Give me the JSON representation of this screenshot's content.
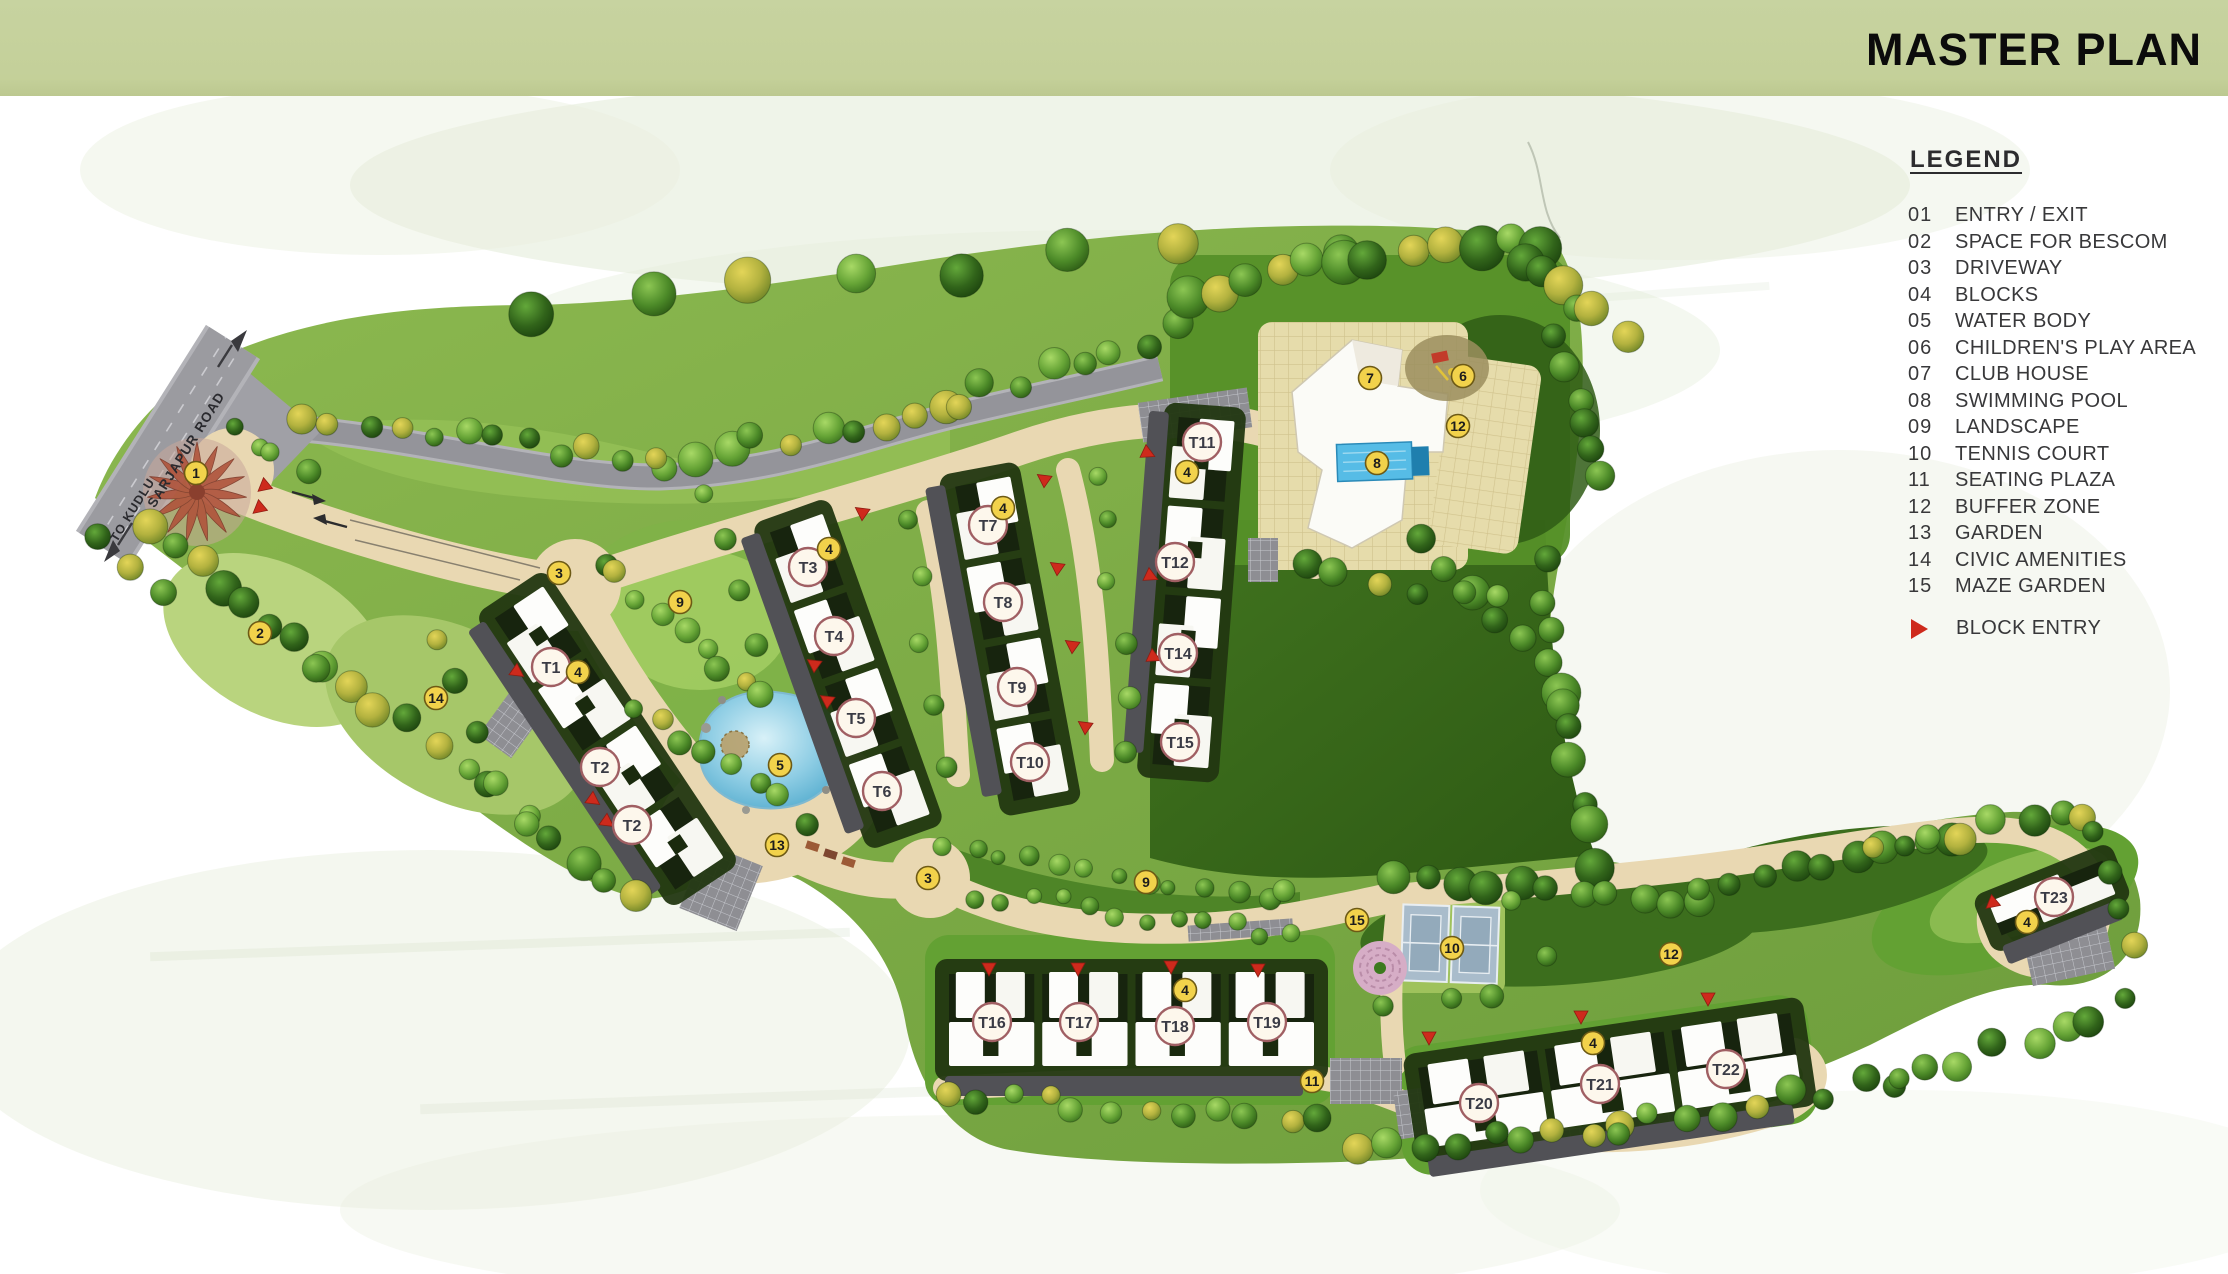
{
  "header": {
    "title": "MASTER PLAN"
  },
  "legend": {
    "title": "LEGEND",
    "items": [
      {
        "num": "01",
        "label": "ENTRY / EXIT"
      },
      {
        "num": "02",
        "label": "SPACE FOR BESCOM"
      },
      {
        "num": "03",
        "label": "DRIVEWAY"
      },
      {
        "num": "04",
        "label": "BLOCKS"
      },
      {
        "num": "05",
        "label": "WATER BODY"
      },
      {
        "num": "06",
        "label": "CHILDREN'S PLAY AREA"
      },
      {
        "num": "07",
        "label": "CLUB  HOUSE"
      },
      {
        "num": "08",
        "label": "SWIMMING POOL"
      },
      {
        "num": "09",
        "label": "LANDSCAPE"
      },
      {
        "num": "10",
        "label": "TENNIS COURT"
      },
      {
        "num": "11",
        "label": "SEATING PLAZA"
      },
      {
        "num": "12",
        "label": "BUFFER ZONE"
      },
      {
        "num": "13",
        "label": "GARDEN"
      },
      {
        "num": "14",
        "label": "CIVIC AMENITIES"
      },
      {
        "num": "15",
        "label": "MAZE GARDEN"
      }
    ],
    "block_entry_label": "BLOCK ENTRY"
  },
  "roads": {
    "sarjapur_label": "SARJAPUR ROAD",
    "kudlu_label": "TO KUDLU"
  },
  "map": {
    "numbered_markers": [
      {
        "n": "1",
        "x": 196,
        "y": 473
      },
      {
        "n": "2",
        "x": 260,
        "y": 633
      },
      {
        "n": "3",
        "x": 559,
        "y": 573
      },
      {
        "n": "3",
        "x": 928,
        "y": 878
      },
      {
        "n": "4",
        "x": 578,
        "y": 672
      },
      {
        "n": "4",
        "x": 829,
        "y": 549
      },
      {
        "n": "4",
        "x": 1003,
        "y": 508
      },
      {
        "n": "4",
        "x": 1187,
        "y": 472
      },
      {
        "n": "4",
        "x": 1185,
        "y": 990
      },
      {
        "n": "4",
        "x": 1593,
        "y": 1043
      },
      {
        "n": "4",
        "x": 2027,
        "y": 922
      },
      {
        "n": "5",
        "x": 780,
        "y": 765
      },
      {
        "n": "6",
        "x": 1463,
        "y": 376
      },
      {
        "n": "7",
        "x": 1370,
        "y": 378
      },
      {
        "n": "8",
        "x": 1377,
        "y": 463
      },
      {
        "n": "9",
        "x": 680,
        "y": 602
      },
      {
        "n": "9",
        "x": 1146,
        "y": 882
      },
      {
        "n": "10",
        "x": 1452,
        "y": 948
      },
      {
        "n": "11",
        "x": 1312,
        "y": 1081
      },
      {
        "n": "12",
        "x": 1458,
        "y": 426
      },
      {
        "n": "12",
        "x": 1671,
        "y": 954
      },
      {
        "n": "13",
        "x": 777,
        "y": 845
      },
      {
        "n": "14",
        "x": 436,
        "y": 698
      },
      {
        "n": "15",
        "x": 1357,
        "y": 920
      }
    ],
    "tower_markers": [
      {
        "t": "T1",
        "x": 551,
        "y": 667
      },
      {
        "t": "T2",
        "x": 600,
        "y": 767
      },
      {
        "t": "T2",
        "x": 632,
        "y": 825
      },
      {
        "t": "T3",
        "x": 808,
        "y": 567
      },
      {
        "t": "T4",
        "x": 834,
        "y": 636
      },
      {
        "t": "T5",
        "x": 856,
        "y": 718
      },
      {
        "t": "T6",
        "x": 882,
        "y": 791
      },
      {
        "t": "T7",
        "x": 988,
        "y": 525
      },
      {
        "t": "T8",
        "x": 1003,
        "y": 602
      },
      {
        "t": "T9",
        "x": 1017,
        "y": 687
      },
      {
        "t": "T10",
        "x": 1030,
        "y": 762
      },
      {
        "t": "T11",
        "x": 1202,
        "y": 442
      },
      {
        "t": "T12",
        "x": 1175,
        "y": 562
      },
      {
        "t": "T14",
        "x": 1178,
        "y": 653
      },
      {
        "t": "T15",
        "x": 1180,
        "y": 742
      },
      {
        "t": "T16",
        "x": 992,
        "y": 1022
      },
      {
        "t": "T17",
        "x": 1079,
        "y": 1022
      },
      {
        "t": "T18",
        "x": 1175,
        "y": 1026
      },
      {
        "t": "T19",
        "x": 1267,
        "y": 1022
      },
      {
        "t": "T20",
        "x": 1479,
        "y": 1103
      },
      {
        "t": "T21",
        "x": 1600,
        "y": 1084
      },
      {
        "t": "T22",
        "x": 1726,
        "y": 1069
      },
      {
        "t": "T23",
        "x": 2054,
        "y": 897
      }
    ],
    "block_entry_arrows": [
      [
        513,
        669,
        35
      ],
      [
        589,
        797,
        35
      ],
      [
        603,
        819,
        35
      ],
      [
        866,
        515,
        215
      ],
      [
        818,
        667,
        215
      ],
      [
        831,
        703,
        215
      ],
      [
        1048,
        482,
        215
      ],
      [
        1061,
        570,
        215
      ],
      [
        1076,
        648,
        215
      ],
      [
        1089,
        729,
        215
      ],
      [
        1143,
        451,
        25
      ],
      [
        1146,
        574,
        25
      ],
      [
        1149,
        655,
        25
      ],
      [
        989,
        963,
        90
      ],
      [
        1078,
        963,
        90
      ],
      [
        1171,
        961,
        90
      ],
      [
        1258,
        964,
        90
      ],
      [
        1429,
        1032,
        90
      ],
      [
        1581,
        1011,
        90
      ],
      [
        1708,
        993,
        90
      ],
      [
        1996,
        900,
        140
      ],
      [
        268,
        483,
        140
      ],
      [
        263,
        505,
        140
      ]
    ]
  },
  "colors": {
    "band_green": "#c4d099",
    "marker_yellow": "#f2d24b",
    "marker_yellow_stroke": "#6d5a15",
    "tower_circle_fill": "#fdf7ec",
    "tower_circle_stroke": "#a05f63",
    "tower_text": "#3a3b45",
    "block_entry_red": "#ce2a1c",
    "driveway_tan": "#e9d8b2",
    "road_gray": "#97979c",
    "pool_blue": "#56bce6"
  }
}
